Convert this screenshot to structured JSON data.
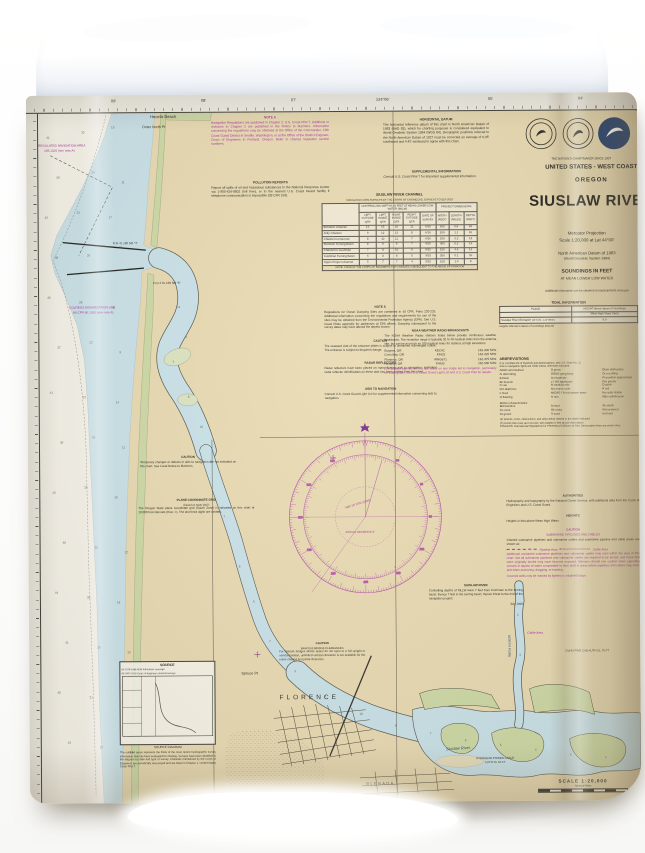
{
  "chart": {
    "top_margin": {
      "ticks": [
        {
          "x": 85,
          "t": "09'"
        },
        {
          "x": 175,
          "t": "08'"
        },
        {
          "x": 265,
          "t": "07'"
        },
        {
          "x": 350,
          "t": "124°06'"
        },
        {
          "x": 462,
          "t": "05'"
        },
        {
          "x": 552,
          "t": "04'"
        }
      ]
    },
    "title_block": {
      "tagline": "THE NATION'S CHARTMAKER SINCE 1807",
      "region": "UNITED STATES - WEST COAST",
      "state": "OREGON",
      "title": "SIUSLAW RIVER",
      "projection": "Mercator Projection",
      "scale": "Scale 1:20,000 at Lat 44°00'",
      "datum": "North American Datum of 1983",
      "datum2": "(World Geodetic System 1984)",
      "soundings": "SOUNDINGS IN FEET",
      "soundings2": "AT MEAN LOWER LOW WATER",
      "info": "Additional information can be obtained at nauticalcharts.noaa.gov"
    },
    "notes": {
      "note_a_title": "NOTE A",
      "note_a": "Navigation Regulations are published in Chapter 2, U.S. Coast Pilot 7. Additions or revisions to Chapter 2 are published in the Notice to Mariners. Information concerning the regulations may be obtained at the Office of the Commander, 13th Coast Guard District in Seattle, Washington, or at the Office of the District Engineer, Corps of Engineers in Portland, Oregon. Refer to charted regulation section numbers.",
      "pollution_title": "POLLUTION REPORTS",
      "pollution": "Report all spills of oil and hazardous substances to the National Response Center via 1-800-424-8802 (toll free), or to the nearest U.S. Coast Guard facility if telephone communication is impossible (33 CFR 153).",
      "horizontal_datum_title": "HORIZONTAL DATUM",
      "horizontal_datum": "The horizontal reference datum of this chart is North American Datum of 1983 (NAD 83), which for charting purposes is considered equivalent to World Geodetic System 1984 (WGS 84). Geographic positions referred to the North American Datum of 1927 must be corrected an average of 0.95' southward and 4.42' eastward to agree with this chart.",
      "supplemental_title": "SUPPLEMENTAL INFORMATION",
      "supplemental": "Consult U.S. Coast Pilot 7 for important supplemental information.",
      "note_s_title": "NOTE S",
      "note_s": "Regulations for Ocean Dumping Sites are contained in 40 CFR, Parts 220-229. Additional information concerning the regulations and requirements for use of the sites may be obtained from the Environmental Protection Agency (EPA). See U.S. Coast Pilots appendix for addresses of EPA offices. Dumping subsequent to the survey dates may have altered the depths shown.",
      "caution_entrance_title": "CAUTION",
      "caution_entrance": "The seaward side of the entrance jetties is subject to unmarked submerged rubble. The entrance is subject to frequent change.",
      "radar_title": "RADAR REFLECTORS",
      "radar": "Radar reflectors have been placed on many floating aids to navigation. Individual radar reflector identification on these aids has been omitted from this chart.",
      "aids_title": "AIDS TO NAVIGATION",
      "aids": "Consult U.S. Coast Guard Light List for supplemental information concerning aids to navigation.",
      "caution_temp_title": "CAUTION",
      "caution_temp": "Temporary changes or defects in aids to navigation are not indicated on this chart. See Local Notice to Mariners.",
      "plane_grid_title": "PLANE COORDINATE GRID",
      "plane_grid_sub": "(based on NAD 1927)",
      "plane_grid": "The Oregon State plane coordinate grid (South Zone) is indicated on this chart at 10,000 foot intervals (thus: +). The last three digits are omitted.",
      "caution_bascule_title": "CAUTION",
      "caution_bascule_sub": "BASCULE BRIDGE CLEARANCES",
      "caution_bascule": "For bascule bridges whose spans do not open to a full upright or vertical position, unlimited vertical clearance is not available for the entire charted horizontal clearance.",
      "siuslaw_title": "SIUSLAW RIVER",
      "siuslaw": "Controlling depths of MLLW were 7 feet from Cushman to the turning basin; thence 7 feet in the turning basin; thence 8 feet to the end of the navigation project.",
      "siuslaw_date": "July 1999",
      "authorities_title": "AUTHORITIES",
      "authorities": "Hydrography and topography by the National Ocean Service, with additional data from the Corps of Engineers and U.S. Coast Guard.",
      "heights_title": "HEIGHTS",
      "heights": "Heights in feet above Mean High Water.",
      "pipelines_title": "CAUTION",
      "pipelines_sub": "SUBMARINE PIPELINES AND CABLES",
      "pipelines_intro": "Charted submarine pipelines and submarine cables and submarine pipeline and cable areas are shown as:",
      "pipelines_legend1": "Pipeline Area",
      "pipelines_legend2": "Cable Area",
      "pipelines": "Additional uncharted submarine pipelines and submarine cables may exist within the area of this chart. Not all submarine pipelines and submarine cables are required to be buried, and those that were originally buried may have become exposed. Mariners should use caution when operating vessels in depths of water comparable to their draft in areas where pipelines and cables may exist, and when anchoring, dragging, or trawling.",
      "pipelines2": "Covered wells may be marked by lighted or unlighted buoys."
    },
    "weather": {
      "title": "NOAA WEATHER RADIO BROADCASTS",
      "text": "The NOAA Weather Radio stations listed below provide continuous weather broadcasts. The reception range is typically 20 to 40 nautical miles from the antenna site, but can be as much as 100 nautical miles for stations at high elevations.",
      "stations": [
        [
          "Eugene, OR",
          "KEC42",
          "162.400 MHz"
        ],
        [
          "Coos Bay, OR",
          "KIH32",
          "162.420 MHz"
        ],
        [
          "Florence, OR",
          "WNG671",
          "162.475 MHz"
        ],
        [
          "Newport, OR",
          "KIH33",
          "162.550 MHz"
        ]
      ],
      "warning": "The prudent mariner will not rely solely on any single aid to navigation, particularly on floating aids. See U.S. Coast Guard Light List and U.S. Coast Pilot for details."
    },
    "channel_table": {
      "title": "SIUSLAW RIVER CHANNEL",
      "subtitle": "TABULATED FROM SURVEYS BY THE CORPS OF ENGINEERS, SURVEYS TO SEP 2016",
      "band1": "CONTROLLING DEPTHS IN FEET AT MEAN LOWER LOW WATER (MLLW)",
      "band2": "PROJECT DIMENSIONS",
      "cols": [
        "NAME OF CHANNEL",
        "LEFT OUTSIDE QTR",
        "LEFT INSIDE QTR",
        "RIGHT INSIDE QTR",
        "RIGHT OUTSIDE QTR",
        "DATE OF SURVEY",
        "WIDTH (FEET)",
        "LENGTH (MILES)",
        "DEPTH (FEET)"
      ],
      "rows": [
        [
          "Entrance Channel",
          "13",
          "15",
          "16",
          "11",
          "6/16",
          "300",
          "0.8",
          "18"
        ],
        [
          "Jetty Channel",
          "9",
          "12",
          "13",
          "8",
          "6/16",
          "200",
          "1.1",
          "16"
        ],
        [
          "Channel to Florence",
          "8",
          "10",
          "11",
          "7",
          "6/16",
          "150",
          "3.2",
          "12"
        ],
        [
          "Florence Turning Basin",
          "8",
          "9",
          "9",
          "7",
          "9/15",
          "300",
          "0.2",
          "12"
        ],
        [
          "Channel to Cushman",
          "7",
          "9",
          "10",
          "6",
          "9/15",
          "150",
          "4.6",
          "12"
        ],
        [
          "Cushman Turning Basin",
          "6",
          "8",
          "8",
          "5",
          "9/15",
          "200",
          "0.1",
          "10"
        ],
        [
          "Upper Project Channel",
          "5",
          "7",
          "7",
          "4",
          "9/15",
          "100",
          "1.4",
          "8"
        ]
      ],
      "footnote": "NOTE: CONSULT THE CORPS OF ENGINEERS FOR CHANGES SUBSEQUENT TO THE ABOVE INFORMATION"
    },
    "tidal_table": {
      "title": "TIDAL INFORMATION",
      "col_place": "PLACE",
      "col_height": "HEIGHT above datum of soundings",
      "col_sub": "Mean High Water (feet)",
      "rows": [
        [
          "Siuslaw River Entrance",
          "(44°01'N., 124°08'W.)",
          "6.9"
        ]
      ],
      "note": "Heights referred to datum of soundings (MLLW)"
    },
    "abbreviations": {
      "title": "ABBREVIATIONS",
      "note": "(For complete list of Symbols and Abbreviations, see U.S. Chart No. 1)",
      "note2": "Aids to navigation lights are white unless otherwise indicated:",
      "col1": [
        "AERO  aeronautical",
        "Al  alternating",
        "B  black",
        "Bn  beacon",
        "C  can",
        "DIA  diaphone",
        "F  fixed",
        "Fl  flashing"
      ],
      "col2": [
        "G  green",
        "GONG  gong buoy",
        "Iso  isophase",
        "LT HO  lighthouse",
        "M  nautical mile",
        "Mo  morse code",
        "MICRO TR  microwave tower",
        "N  nun"
      ],
      "col3": [
        "Obstr  obstruction",
        "Oc  occulting",
        "PA  position approximate",
        "Priv  private",
        "Q  quick",
        "R  red",
        "Ra  radar station",
        "RBn  radiobeacon"
      ],
      "group2_title": "Bottom characteristics",
      "g2col1": [
        "Bld  boulders",
        "Co  coral",
        "Gr  gravel"
      ],
      "g2col2": [
        "M  mud",
        "Rk  rocky",
        "S  sand"
      ],
      "g2col3": [
        "Sh  shells",
        "Wd  seaweed",
        "hrd  hard"
      ],
      "misc_notes": [
        "(2) Wrecks, rocks, obstructions, and other areas cleared to the depth indicated",
        "(C) Rocks that cover and uncover, with heights in feet above chart datum",
        "COLREGS: International Regulations for Preventing Collisions at Sea. Demarcation lines are shown thus:"
      ]
    },
    "source": {
      "title": "SOURCE",
      "legend": [
        "S4   1979-1986   NOS full-bottom coverage",
        "S6   1997-2016   Corps of Engineers channel surveys"
      ],
      "caption": "SOURCE DIAGRAM",
      "text": "The outlined areas represent the limits of the most recent hydrographic survey information that has been evaluated for charting. Surveys have been identified in the diagram by date and type of survey. Channels maintained by the Corps of Engineers are periodically resurveyed and are listed in Chapter 1, United States Coast Pilot 7."
    },
    "scale_block": {
      "scale": "SCALE 1:20,000",
      "units": "Nautical Miles"
    },
    "map": {
      "labels": [
        {
          "t": "Heceta Beach",
          "x": 124,
          "y": 19,
          "s": 4.2,
          "c": "#2f2f2a"
        },
        {
          "t": "Outer North Pt",
          "x": 116,
          "y": 30,
          "s": 3.6,
          "c": "#2f2f2a"
        },
        {
          "t": "REGULATED NAVIGATION AREA",
          "x": 12,
          "y": 48,
          "s": 3.1,
          "c": "#a8309c"
        },
        {
          "t": "165.1325 (see note A)",
          "x": 18,
          "y": 53,
          "s": 3.1,
          "c": "#a8309c"
        },
        {
          "t": "COLREGS DEMARCATION LINE",
          "x": 42,
          "y": 210,
          "s": 3.1,
          "c": "#a8309c"
        },
        {
          "t": "80 CFR 80.1305 (see note A)",
          "x": 46,
          "y": 215,
          "s": 3.1,
          "c": "#a8309c"
        },
        {
          "t": "Fl R 4s 16ft 5M \"4\"",
          "x": 86,
          "y": 146,
          "s": 3,
          "c": "#33332e"
        },
        {
          "t": "Fl G 2.5s 15ft 5M \"5\"",
          "x": 126,
          "y": 186,
          "s": 3,
          "c": "#33332e"
        },
        {
          "t": "Spruce Pt",
          "x": 212,
          "y": 577,
          "s": 3.8,
          "c": "#2f2f2a"
        },
        {
          "t": "FLORENCE",
          "x": 250,
          "y": 600,
          "s": 6.5,
          "c": "#2f2f2a",
          "ls": 3
        },
        {
          "t": "GLENADA",
          "x": 336,
          "y": 688,
          "s": 3.8,
          "c": "#2f2f2a",
          "ls": 1.5
        },
        {
          "t": "NORTH FORK",
          "x": 482,
          "y": 542,
          "s": 3.4,
          "c": "#2f4f7a",
          "rot": 90,
          "i": 1
        },
        {
          "t": "Siuslaw River",
          "x": 416,
          "y": 653,
          "s": 4,
          "c": "#2f4f7a",
          "i": 1,
          "rot": -3
        },
        {
          "t": "Cable Area",
          "x": 498,
          "y": 538,
          "s": 3.2,
          "c": "#a8309c",
          "i": 1
        },
        {
          "t": "OVERHEAD POWER CABLE",
          "x": 446,
          "y": 663,
          "s": 2.9,
          "c": "#33332e"
        },
        {
          "t": "AUTH CL 66 FT",
          "x": 455,
          "y": 667,
          "s": 2.9,
          "c": "#33332e"
        },
        {
          "t": "OVHD PWR CAB AUTH CL 75 FT",
          "x": 536,
          "y": 556,
          "s": 2.9,
          "c": "#33332e"
        },
        {
          "t": "VAR 16°15'E (1999)",
          "x": 316,
          "y": 412,
          "s": 3,
          "c": "#a8309c",
          "rot": -17
        },
        {
          "t": "ANNUAL DECREASE 8'",
          "x": 317,
          "y": 437,
          "s": 2.7,
          "c": "#a8309c"
        }
      ],
      "soundings": [
        [
          20,
          40,
          41
        ],
        [
          55,
          35,
          30
        ],
        [
          85,
          30,
          15
        ],
        [
          30,
          80,
          39
        ],
        [
          65,
          75,
          24
        ],
        [
          95,
          85,
          11
        ],
        [
          18,
          120,
          42
        ],
        [
          50,
          115,
          31
        ],
        [
          82,
          120,
          17
        ],
        [
          28,
          160,
          38
        ],
        [
          60,
          158,
          26
        ],
        [
          92,
          150,
          13
        ],
        [
          20,
          200,
          40
        ],
        [
          52,
          205,
          28
        ],
        [
          84,
          210,
          12
        ],
        [
          30,
          250,
          37
        ],
        [
          62,
          245,
          22
        ],
        [
          92,
          255,
          9
        ],
        [
          22,
          295,
          41
        ],
        [
          55,
          300,
          27
        ],
        [
          88,
          305,
          14
        ],
        [
          32,
          345,
          39
        ],
        [
          64,
          340,
          24
        ],
        [
          94,
          350,
          11
        ],
        [
          24,
          395,
          43
        ],
        [
          56,
          390,
          29
        ],
        [
          86,
          400,
          15
        ],
        [
          34,
          445,
          40
        ],
        [
          66,
          450,
          25
        ],
        [
          96,
          455,
          12
        ],
        [
          26,
          495,
          44
        ],
        [
          58,
          500,
          30
        ],
        [
          88,
          505,
          16
        ],
        [
          36,
          545,
          41
        ],
        [
          68,
          550,
          26
        ],
        [
          98,
          555,
          13
        ],
        [
          28,
          595,
          45
        ],
        [
          60,
          600,
          31
        ],
        [
          90,
          605,
          17
        ],
        [
          38,
          645,
          42
        ],
        [
          70,
          650,
          27
        ],
        [
          100,
          655,
          14
        ],
        [
          150,
          210,
          11
        ],
        [
          158,
          240,
          9
        ],
        [
          145,
          265,
          7
        ],
        [
          160,
          300,
          8
        ],
        [
          172,
          330,
          10
        ],
        [
          182,
          365,
          9
        ],
        [
          195,
          420,
          7
        ],
        [
          210,
          470,
          8
        ],
        [
          224,
          505,
          6
        ],
        [
          240,
          545,
          7
        ],
        [
          265,
          575,
          9
        ],
        [
          295,
          600,
          8
        ],
        [
          330,
          618,
          10
        ],
        [
          365,
          630,
          9
        ],
        [
          400,
          638,
          7
        ],
        [
          435,
          645,
          6
        ],
        [
          470,
          650,
          5
        ],
        [
          505,
          655,
          4
        ],
        [
          540,
          660,
          5
        ],
        [
          575,
          663,
          4
        ],
        [
          490,
          560,
          3
        ],
        [
          488,
          520,
          2
        ]
      ]
    },
    "colors": {
      "land": "#e8dab2",
      "shallow_water": "#c9e2e9",
      "ocean": "#f6f3ea",
      "marsh_green": "#cdd9a5",
      "magenta": "#a8309c",
      "compass_pink": "#b75aa8"
    }
  }
}
